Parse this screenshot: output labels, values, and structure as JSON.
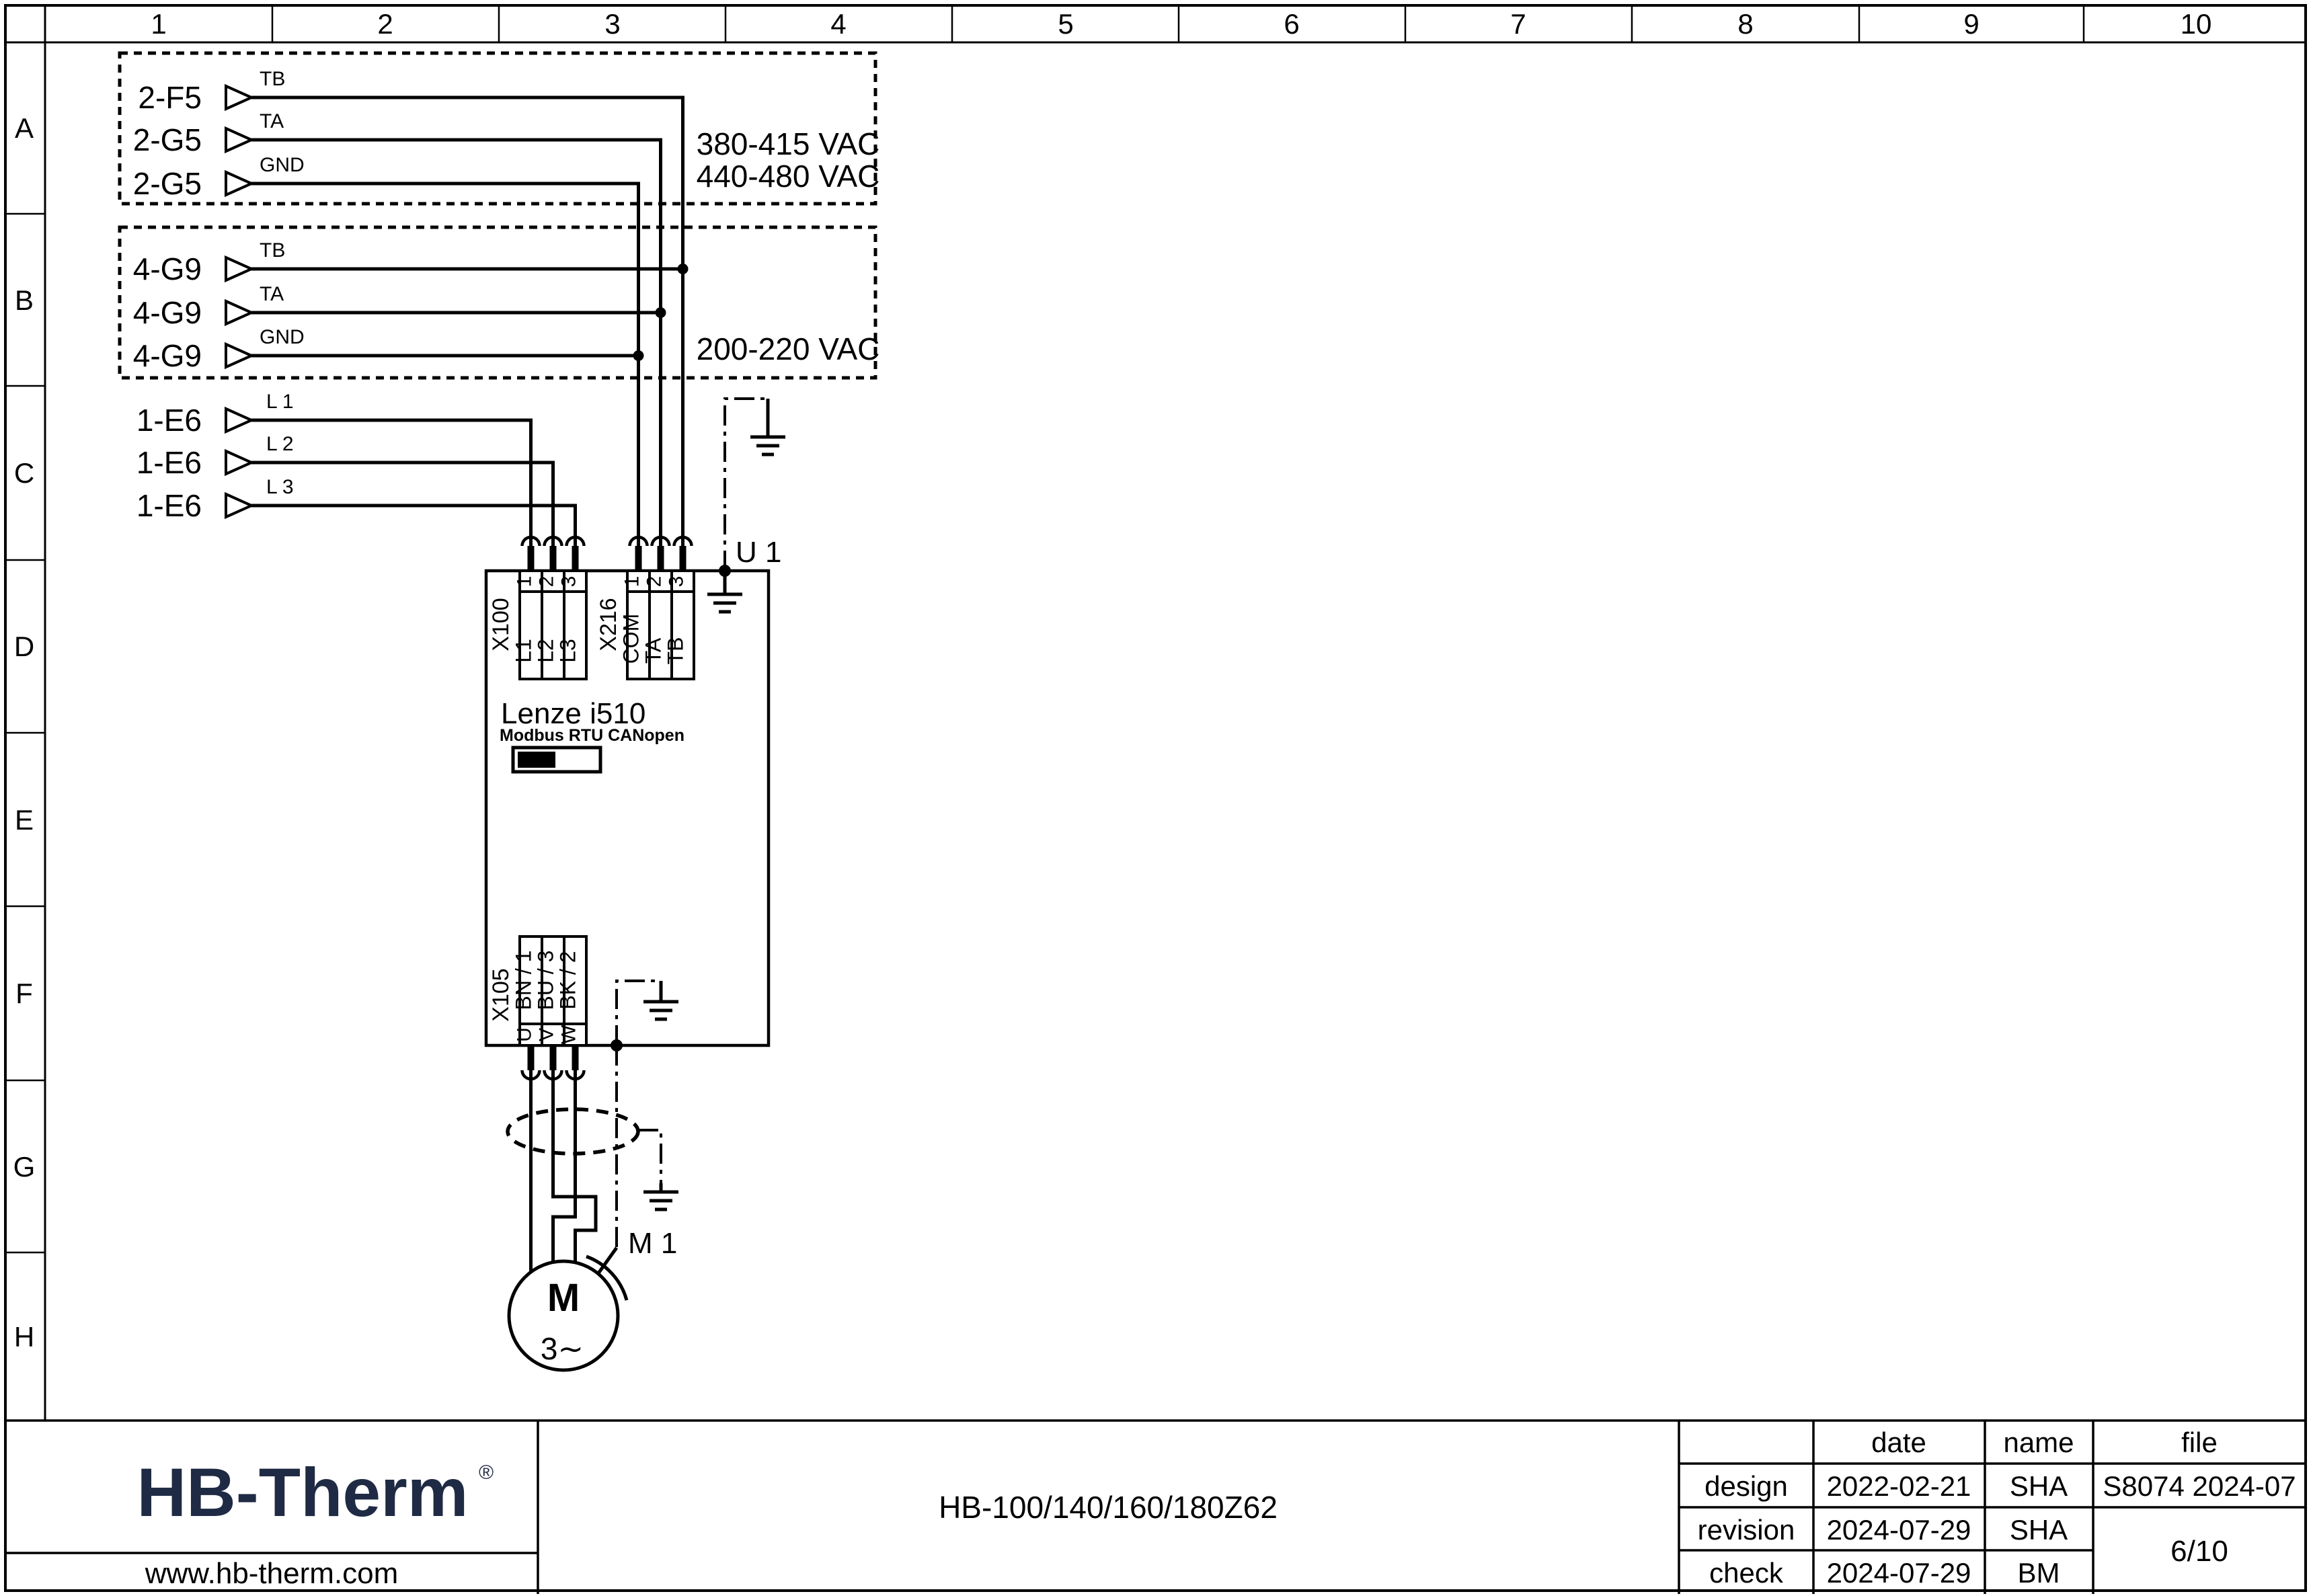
{
  "page": {
    "bg": "#ffffff",
    "line_color": "#000000",
    "logo_color": "#1f2a44"
  },
  "ruler": {
    "columns": [
      "1",
      "2",
      "3",
      "4",
      "5",
      "6",
      "7",
      "8",
      "9",
      "10"
    ],
    "rows": [
      "A",
      "B",
      "C",
      "D",
      "E",
      "F",
      "G",
      "H"
    ]
  },
  "signals": {
    "box_a": {
      "voltages": [
        "380-415 VAC",
        "440-480 VAC"
      ],
      "items": [
        {
          "ref": "2-F5",
          "wire": "TB"
        },
        {
          "ref": "2-G5",
          "wire": "TA"
        },
        {
          "ref": "2-G5",
          "wire": "GND"
        }
      ]
    },
    "box_b": {
      "voltages": [
        "200-220 VAC"
      ],
      "items": [
        {
          "ref": "4-G9",
          "wire": "TB"
        },
        {
          "ref": "4-G9",
          "wire": "TA"
        },
        {
          "ref": "4-G9",
          "wire": "GND"
        }
      ]
    },
    "mains": {
      "items": [
        {
          "ref": "1-E6",
          "wire": "L 1"
        },
        {
          "ref": "1-E6",
          "wire": "L 2"
        },
        {
          "ref": "1-E6",
          "wire": "L 3"
        }
      ]
    }
  },
  "drive": {
    "designation": "U 1",
    "name": "Lenze i510",
    "comm_label": "Modbus RTU CANopen",
    "x100": {
      "name": "X100",
      "terminals": [
        {
          "no": "1",
          "label": "L1"
        },
        {
          "no": "2",
          "label": "L2"
        },
        {
          "no": "3",
          "label": "L3"
        }
      ]
    },
    "x216": {
      "name": "X216",
      "terminals": [
        {
          "no": "1",
          "label": "COM"
        },
        {
          "no": "2",
          "label": "TA"
        },
        {
          "no": "3",
          "label": "TB"
        }
      ]
    },
    "x105": {
      "name": "X105",
      "terminals": [
        {
          "no": "U",
          "label": "BN / 1"
        },
        {
          "no": "V",
          "label": "BU / 3"
        },
        {
          "no": "W",
          "label": "BK / 2"
        }
      ]
    }
  },
  "motor": {
    "designation": "M 1",
    "symbol": "M",
    "phase": "3∼"
  },
  "title_block": {
    "logo": "HB-Therm",
    "logo_reg": "®",
    "website": "www.hb-therm.com",
    "doc_title": "HB-100/140/160/180Z62",
    "table": {
      "headers": {
        "date": "date",
        "name": "name",
        "file": "file"
      },
      "rows": [
        {
          "label": "design",
          "date": "2022-02-21",
          "name": "SHA"
        },
        {
          "label": "revision",
          "date": "2024-07-29",
          "name": "SHA"
        },
        {
          "label": "check",
          "date": "2024-07-29",
          "name": "BM"
        }
      ],
      "file_value": "S8074 2024-07",
      "page": "6/10"
    }
  }
}
